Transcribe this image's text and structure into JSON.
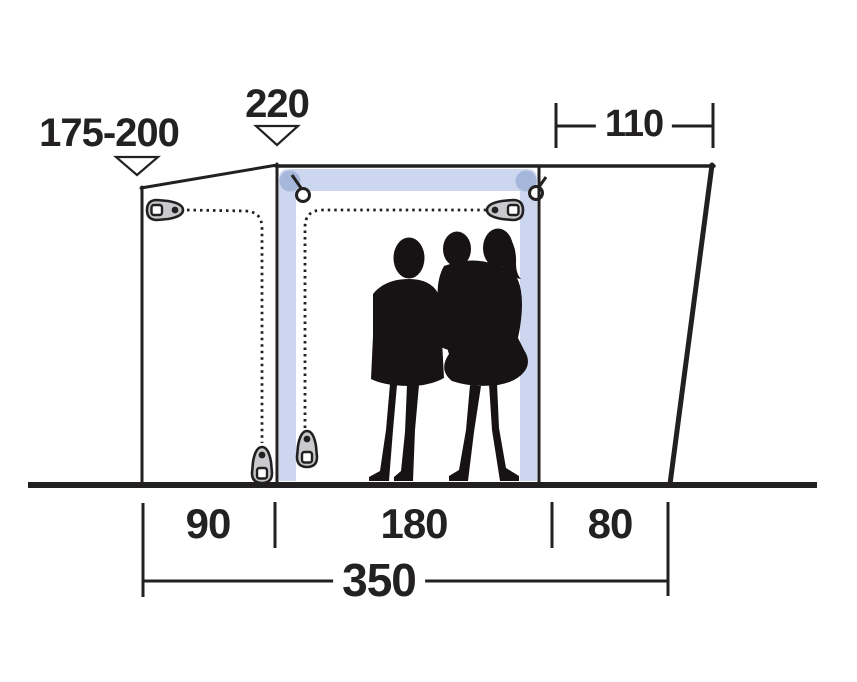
{
  "diagram": {
    "type": "tent-dimension-drawing",
    "subject": "drive-away awning side profile with door, zipper paths and people silhouettes",
    "labels": {
      "height_range": "175-200",
      "peak_height": "220",
      "top_width": "110",
      "segment_left": "90",
      "segment_middle": "180",
      "segment_right": "80",
      "total_width": "350"
    },
    "colors": {
      "outline": "#232021",
      "door_trim": "#ccd6ee",
      "door_trim_corner": "#a6b7dc",
      "zipper_pull_fill": "#c9cacd",
      "silhouette": "#171314",
      "background": "#ffffff"
    }
  }
}
